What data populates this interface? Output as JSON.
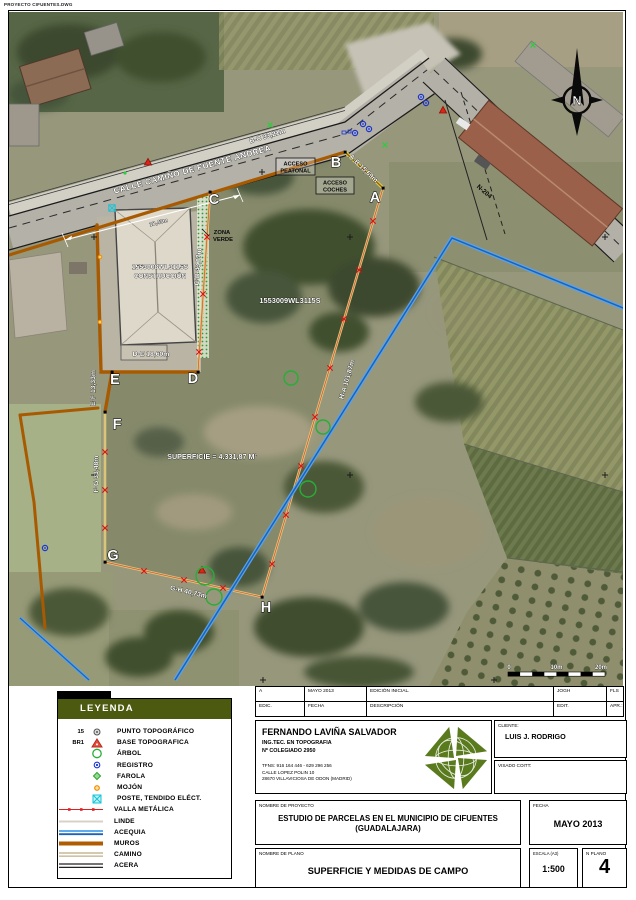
{
  "page": {
    "doc_label": "PROYECTO CIFUENTES.DWG"
  },
  "map": {
    "street": "CALLE CAMIÑO DE FUENTE ANDREA",
    "street_dim": "18,43m",
    "road": "N-204",
    "north": "N",
    "acceso_peatonal_1": "ACCESO",
    "acceso_peatonal_2": "PEATONAL",
    "acceso_coches_1": "ACCESO",
    "acceso_coches_2": "COCHES",
    "zona_verde_1": "ZONA",
    "zona_verde_2": "VERDE",
    "parcel_construction_ref": "1553008WL3115S",
    "parcel_construction_sub": "CONSTRUCCIÓN",
    "parcel_main_ref": "1553009WL3115S",
    "superficie": "SUPERFICIE = 4.331,87 M²",
    "vertices": {
      "a": "A",
      "b": "B",
      "c": "C",
      "d": "D",
      "e": "E",
      "f": "F",
      "g": "G",
      "h": "H"
    },
    "dims": {
      "ab": "A-B 15,69m",
      "bc": "B-C 33,21m",
      "cd": "C-D 43,07m",
      "de": "D-E 18,60m",
      "ef": "E-F 13,33m",
      "fg": "F-G 33,48m",
      "gh": "G-H 40,73m",
      "ha": "H-A 101,87m"
    },
    "scale_ticks": [
      "0",
      "10m",
      "20m"
    ]
  },
  "legend": {
    "title": "LEYENDA",
    "items": [
      {
        "prefix": "15",
        "label": "PUNTO TOPOGRÁFICO"
      },
      {
        "prefix": "BR1",
        "label": "BASE TOPOGRAFICA"
      },
      {
        "prefix": "",
        "label": "ÁRBOL"
      },
      {
        "prefix": "",
        "label": "REGISTRO"
      },
      {
        "prefix": "",
        "label": "FAROLA"
      },
      {
        "prefix": "",
        "label": "MOJÓN"
      },
      {
        "prefix": "",
        "label": "POSTE, TENDIDO ELÉCT."
      },
      {
        "prefix": "",
        "label": "VALLA METÁLICA"
      },
      {
        "prefix": "",
        "label": "LINDE"
      },
      {
        "prefix": "",
        "label": "ACEQUIA"
      },
      {
        "prefix": "",
        "label": "MUROS"
      },
      {
        "prefix": "",
        "label": "CAMINO"
      },
      {
        "prefix": "",
        "label": "ACERA"
      }
    ]
  },
  "titleblock": {
    "rev": {
      "a": "A",
      "date": "MAYO 2013",
      "desc": "EDICIÓN INICIAL.",
      "edit": "JOGH",
      "apr": "FLS"
    },
    "head": {
      "a": "EDIC.",
      "date": "FECHA",
      "desc": "DESCRIPCIÓN",
      "edit": "EDIT.",
      "apr": "APR.:"
    },
    "author": {
      "name": "FERNANDO LAVIÑA SALVADOR",
      "role": "ING.TEC. EN TOPOGRAFIA",
      "college": "Nº COLEGIADO 2950",
      "phones": "TFNS: 916 164 446 - 629 296 256",
      "street": "CALLE LOPEZ POLIN 10",
      "city": "28670 VILLAVICIOSA DE ODON (MADRID)"
    },
    "client_label": "CLIENTE:",
    "client": "LUIS J. RODRIGO",
    "visado_label": "VISADO COITT:",
    "project_label": "NOMBRE DE PROYECTO",
    "project": "ESTUDIO DE PARCELAS EN EL MUNICIPIO DE CIFUENTES (GUADALAJARA)",
    "fecha_label": "FECHA",
    "fecha": "MAYO 2013",
    "plan_label": "NOMBRE DE PLANO",
    "plan": "SUPERFICIE Y MEDIDAS DE CAMPO",
    "escala_label": "ESCALA (A3)",
    "escala": "1:500",
    "nplano_label": "N PLANO",
    "nplano": "4"
  },
  "colors": {
    "legend_header": "#4c5a0f",
    "muro": "#a85a00",
    "acequia": "#2b7bd0",
    "valla": "#e02020",
    "logo_green": "#5a7a1e"
  }
}
